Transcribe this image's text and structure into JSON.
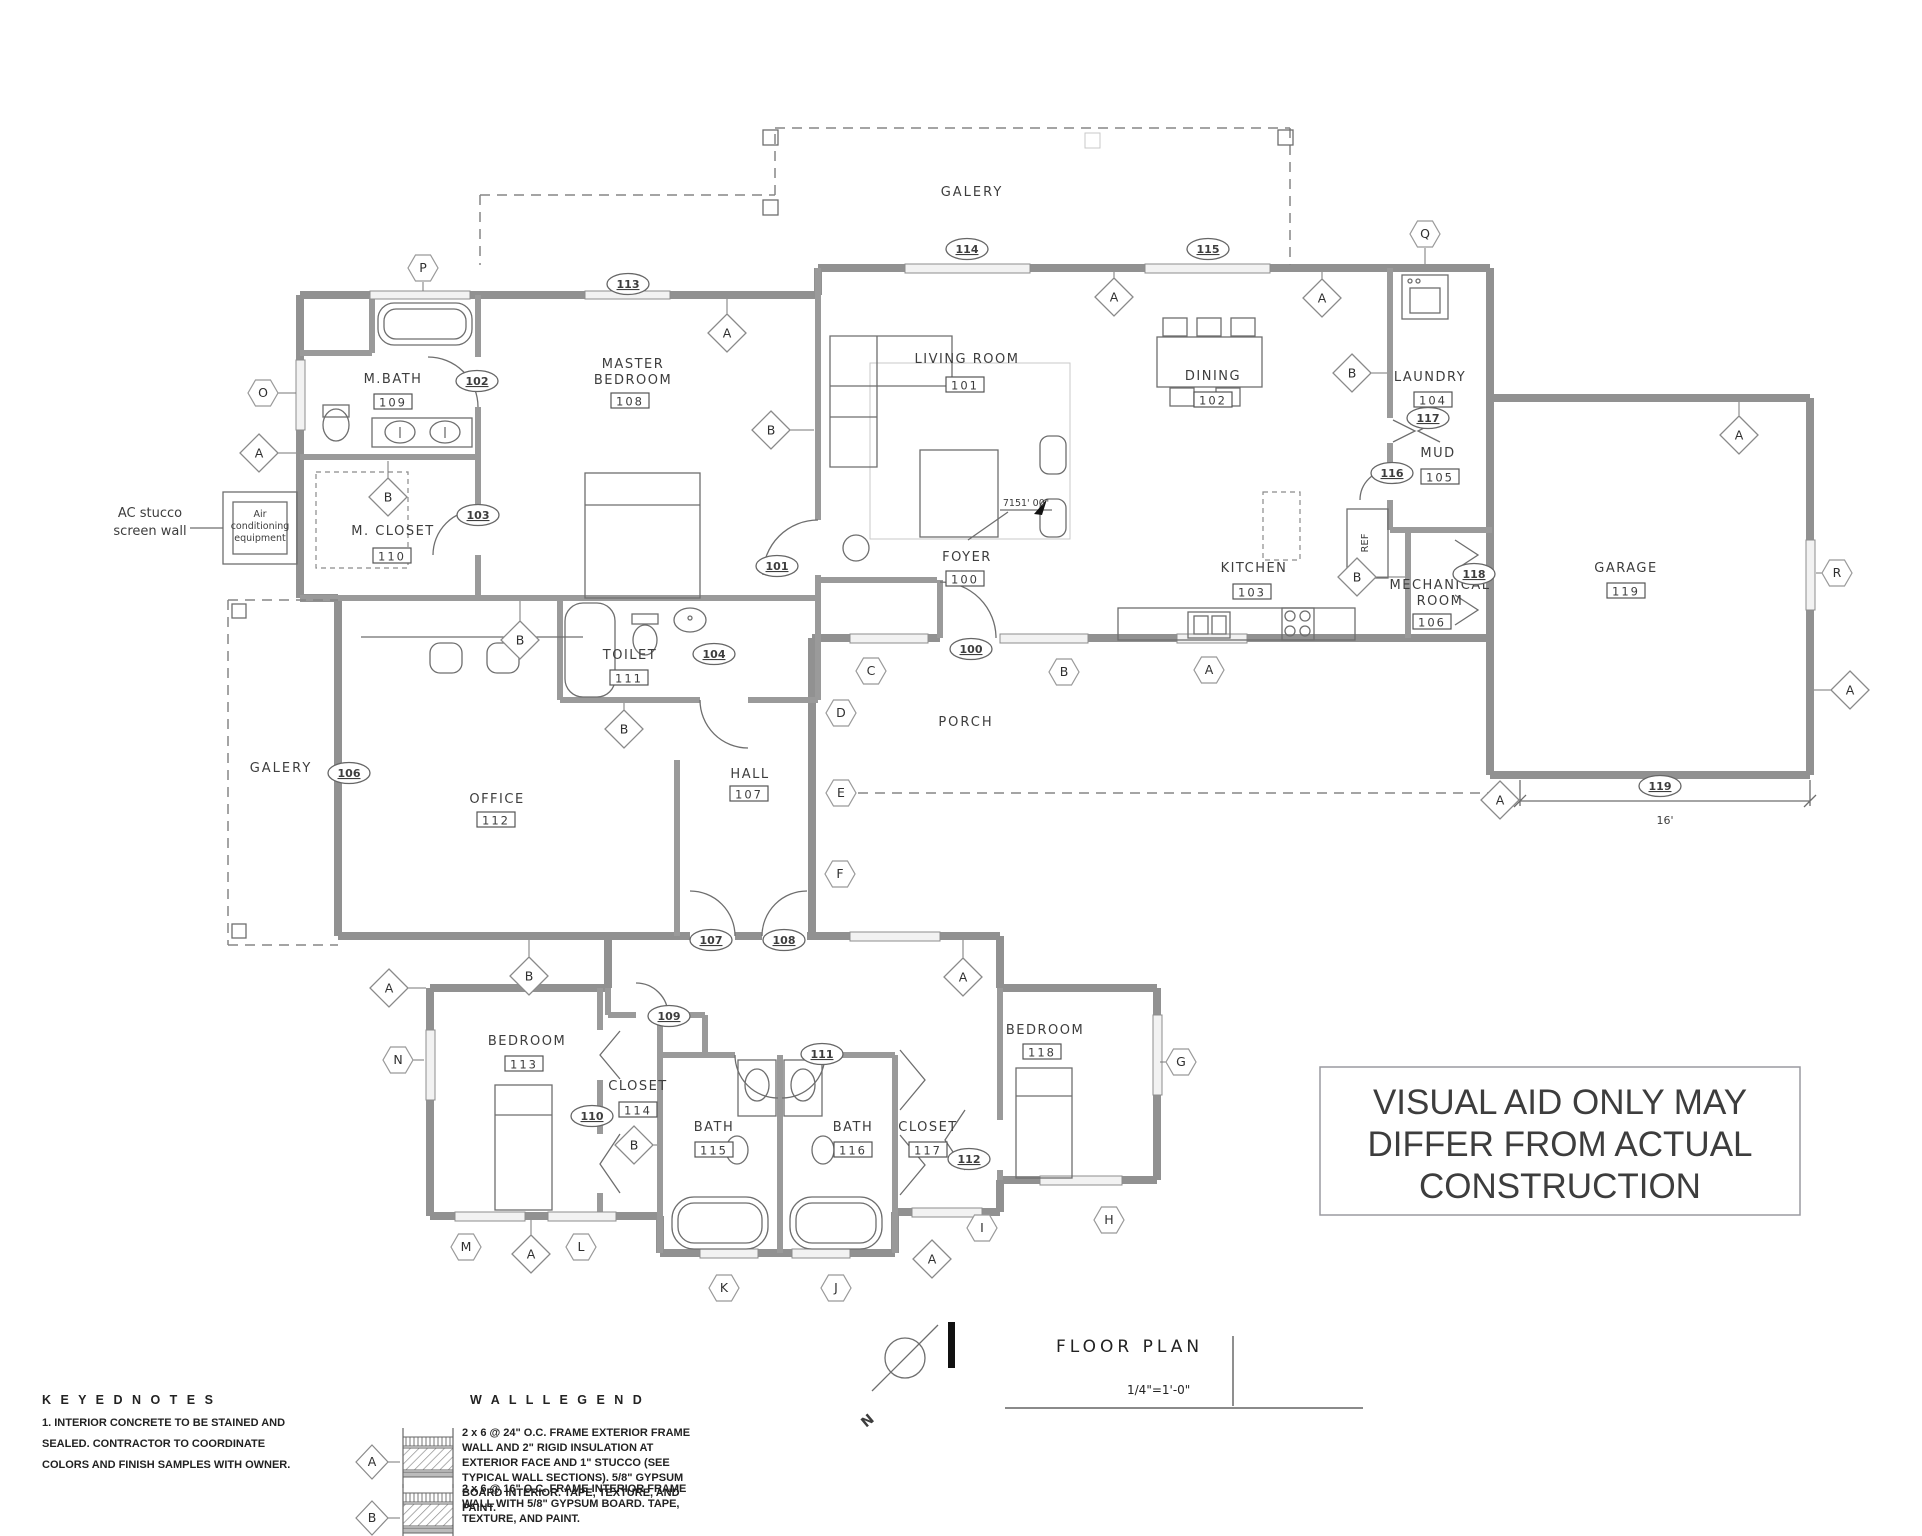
{
  "title_block": {
    "title": "FLOOR PLAN",
    "scale": "1/4\"=1'-0\""
  },
  "north_label": "N",
  "disclaimer": {
    "color": "#dc2f27",
    "lines": [
      "VISUAL AID ONLY MAY",
      "DIFFER FROM ACTUAL",
      "CONSTRUCTION"
    ]
  },
  "rooms": [
    {
      "name": [
        "LIVING ROOM"
      ],
      "num": "101",
      "x": 967,
      "y": 363,
      "bx": 965,
      "by": 385
    },
    {
      "name": [
        "DINING"
      ],
      "num": "102",
      "x": 1213,
      "y": 380,
      "bx": 1213,
      "by": 400
    },
    {
      "name": [
        "KITCHEN"
      ],
      "num": "103",
      "x": 1254,
      "y": 572,
      "bx": 1252,
      "by": 592
    },
    {
      "name": [
        "LAUNDRY"
      ],
      "num": "104",
      "x": 1430,
      "y": 381,
      "bx": 1433,
      "by": 400
    },
    {
      "name": [
        "MUD"
      ],
      "num": "105",
      "x": 1438,
      "y": 457,
      "bx": 1440,
      "by": 477
    },
    {
      "name": [
        "MECHANICAL",
        "ROOM"
      ],
      "num": "106",
      "x": 1440,
      "y": 589,
      "bx": 1432,
      "by": 622
    },
    {
      "name": [
        "HALL"
      ],
      "num": "107",
      "x": 750,
      "y": 778,
      "bx": 749,
      "by": 794
    },
    {
      "name": [
        "MASTER",
        "BEDROOM"
      ],
      "num": "108",
      "x": 633,
      "y": 368,
      "bx": 630,
      "by": 401
    },
    {
      "name": [
        "M.BATH"
      ],
      "num": "109",
      "x": 393,
      "y": 383,
      "bx": 393,
      "by": 402
    },
    {
      "name": [
        "M. CLOSET"
      ],
      "num": "110",
      "x": 393,
      "y": 535,
      "bx": 392,
      "by": 556
    },
    {
      "name": [
        "TOILET"
      ],
      "num": "111",
      "x": 630,
      "y": 659,
      "bx": 629,
      "by": 678
    },
    {
      "name": [
        "OFFICE"
      ],
      "num": "112",
      "x": 497,
      "y": 803,
      "bx": 496,
      "by": 820
    },
    {
      "name": [
        "BEDROOM"
      ],
      "num": "113",
      "x": 527,
      "y": 1045,
      "bx": 524,
      "by": 1064
    },
    {
      "name": [
        "CLOSET"
      ],
      "num": "114",
      "x": 638,
      "y": 1090,
      "bx": 638,
      "by": 1110
    },
    {
      "name": [
        "BATH"
      ],
      "num": "115",
      "x": 714,
      "y": 1131,
      "bx": 714,
      "by": 1150
    },
    {
      "name": [
        "BATH"
      ],
      "num": "116",
      "x": 853,
      "y": 1131,
      "bx": 853,
      "by": 1150
    },
    {
      "name": [
        "CLOSET"
      ],
      "num": "117",
      "x": 928,
      "y": 1131,
      "bx": 928,
      "by": 1150
    },
    {
      "name": [
        "BEDROOM"
      ],
      "num": "118",
      "x": 1045,
      "y": 1034,
      "bx": 1042,
      "by": 1052
    },
    {
      "name": [
        "GARAGE"
      ],
      "num": "119",
      "x": 1626,
      "y": 572,
      "bx": 1626,
      "by": 591
    },
    {
      "name": [
        "FOYER"
      ],
      "num": "100",
      "x": 967,
      "y": 561,
      "bx": 965,
      "by": 579
    }
  ],
  "plain_labels": [
    {
      "t": "GALERY",
      "x": 972,
      "y": 196,
      "s": 13,
      "ls": 2
    },
    {
      "t": "GALERY",
      "x": 281,
      "y": 772,
      "s": 13,
      "ls": 2
    },
    {
      "t": "PORCH",
      "x": 966,
      "y": 726,
      "s": 13,
      "ls": 2
    },
    {
      "t": "REF",
      "x": 1368,
      "y": 543,
      "s": 10,
      "rot": -90
    },
    {
      "t": "7151' 00\"",
      "x": 1026,
      "y": 506,
      "s": 9.5
    },
    {
      "t": "16'",
      "x": 1665,
      "y": 824,
      "s": 11
    },
    {
      "t": "AC stucco",
      "x": 150,
      "y": 517,
      "s": 13,
      "a": "middle"
    },
    {
      "t": "screen wall",
      "x": 150,
      "y": 535,
      "s": 13,
      "a": "middle"
    },
    {
      "t": "Air",
      "x": 260,
      "y": 517,
      "s": 9.5,
      "a": "middle"
    },
    {
      "t": "conditioning",
      "x": 260,
      "y": 529,
      "s": 9.5,
      "a": "middle"
    },
    {
      "t": "equipment",
      "x": 260,
      "y": 541,
      "s": 9.5,
      "a": "middle"
    }
  ],
  "door_tags": [
    {
      "n": "100",
      "x": 971,
      "y": 649
    },
    {
      "n": "101",
      "x": 777,
      "y": 566
    },
    {
      "n": "102",
      "x": 477,
      "y": 381
    },
    {
      "n": "103",
      "x": 478,
      "y": 515
    },
    {
      "n": "104",
      "x": 714,
      "y": 654
    },
    {
      "n": "106",
      "x": 349,
      "y": 773
    },
    {
      "n": "107",
      "x": 711,
      "y": 940
    },
    {
      "n": "108",
      "x": 784,
      "y": 940
    },
    {
      "n": "109",
      "x": 669,
      "y": 1016
    },
    {
      "n": "110",
      "x": 592,
      "y": 1116
    },
    {
      "n": "111",
      "x": 822,
      "y": 1054
    },
    {
      "n": "112",
      "x": 969,
      "y": 1159
    },
    {
      "n": "113",
      "x": 628,
      "y": 284
    },
    {
      "n": "114",
      "x": 967,
      "y": 249
    },
    {
      "n": "115",
      "x": 1208,
      "y": 249
    },
    {
      "n": "116",
      "x": 1392,
      "y": 473
    },
    {
      "n": "117",
      "x": 1428,
      "y": 418
    },
    {
      "n": "118",
      "x": 1474,
      "y": 574
    },
    {
      "n": "119",
      "x": 1660,
      "y": 786
    }
  ],
  "wall_type_markers": [
    {
      "l": "A",
      "x": 259,
      "y": 453,
      "lx": 296,
      "ly": 453
    },
    {
      "l": "A",
      "x": 727,
      "y": 333,
      "lx": 727,
      "ly": 299
    },
    {
      "l": "A",
      "x": 1114,
      "y": 297,
      "lx": 1114,
      "ly": 272
    },
    {
      "l": "A",
      "x": 1322,
      "y": 298,
      "lx": 1322,
      "ly": 272
    },
    {
      "l": "A",
      "x": 1739,
      "y": 435,
      "lx": 1739,
      "ly": 402
    },
    {
      "l": "A",
      "x": 389,
      "y": 988,
      "lx": 426,
      "ly": 988
    },
    {
      "l": "A",
      "x": 963,
      "y": 977,
      "lx": 963,
      "ly": 940
    },
    {
      "l": "A",
      "x": 531,
      "y": 1254,
      "lx": 531,
      "ly": 1220
    },
    {
      "l": "A",
      "x": 932,
      "y": 1259,
      "lx": 932,
      "ly": 1256
    },
    {
      "l": "A",
      "x": 1500,
      "y": 800
    },
    {
      "l": "A",
      "x": 1850,
      "y": 690,
      "lx": 1814,
      "ly": 690
    },
    {
      "l": "B",
      "x": 388,
      "y": 497,
      "lx": 388,
      "ly": 461
    },
    {
      "l": "B",
      "x": 771,
      "y": 430,
      "lx": 814,
      "ly": 430
    },
    {
      "l": "B",
      "x": 520,
      "y": 640,
      "lx": 520,
      "ly": 601
    },
    {
      "l": "B",
      "x": 624,
      "y": 729,
      "lx": 624,
      "ly": 703
    },
    {
      "l": "B",
      "x": 529,
      "y": 976,
      "lx": 529,
      "ly": 940
    },
    {
      "l": "B",
      "x": 634,
      "y": 1145,
      "lx": 657,
      "ly": 1145
    },
    {
      "l": "B",
      "x": 1352,
      "y": 373,
      "lx": 1387,
      "ly": 373
    },
    {
      "l": "B",
      "x": 1357,
      "y": 577,
      "lx": 1405,
      "ly": 577
    }
  ],
  "elevation_markers": [
    {
      "l": "C",
      "x": 871,
      "y": 671
    },
    {
      "l": "D",
      "x": 841,
      "y": 713
    },
    {
      "l": "E",
      "x": 841,
      "y": 793
    },
    {
      "l": "F",
      "x": 840,
      "y": 874
    },
    {
      "l": "B",
      "x": 1064,
      "y": 672
    },
    {
      "l": "A",
      "x": 1209,
      "y": 670
    },
    {
      "l": "G",
      "x": 1181,
      "y": 1062,
      "lx": 1160,
      "ly": 1062
    },
    {
      "l": "H",
      "x": 1109,
      "y": 1220
    },
    {
      "l": "I",
      "x": 982,
      "y": 1228
    },
    {
      "l": "J",
      "x": 836,
      "y": 1288
    },
    {
      "l": "K",
      "x": 724,
      "y": 1288
    },
    {
      "l": "L",
      "x": 581,
      "y": 1247
    },
    {
      "l": "M",
      "x": 466,
      "y": 1247
    },
    {
      "l": "N",
      "x": 398,
      "y": 1060,
      "lx": 424,
      "ly": 1060
    },
    {
      "l": "O",
      "x": 263,
      "y": 393,
      "lx": 296,
      "ly": 393
    },
    {
      "l": "P",
      "x": 423,
      "y": 268,
      "lx": 423,
      "ly": 291
    },
    {
      "l": "Q",
      "x": 1425,
      "y": 234,
      "lx": 1425,
      "ly": 264
    },
    {
      "l": "R",
      "x": 1837,
      "y": 573,
      "lx": 1816,
      "ly": 573
    }
  ],
  "keyed_notes": {
    "header": "K E Y E D N O T E S",
    "lines": [
      "1.      INTERIOR CONCRETE TO BE STAINED AND",
      "SEALED.       CONTRACTOR TO COORDINATE",
      "COLORS AND FINISH SAMPLES WITH OWNER."
    ]
  },
  "wall_legend": {
    "header": "W A L L L E G E N D",
    "items": [
      {
        "tag": "A",
        "lines": [
          "2 x 6 @ 24\" O.C. FRAME EXTERIOR FRAME",
          "WALL AND 2\" RIGID INSULATION AT",
          "EXTERIOR FACE AND 1\" STUCCO (SEE",
          "TYPICAL WALL SECTIONS). 5/8\" GYPSUM",
          "BOARD INTERIOR. TAPE, TEXTURE, AND",
          "PAINT."
        ]
      },
      {
        "tag": "B",
        "lines": [
          "2 x 6 @ 16\" O.C. FRAME INTERIOR FRAME",
          "WALL WITH 5/8\" GYPSUM BOARD. TAPE,",
          "TEXTURE, AND PAINT."
        ]
      }
    ]
  }
}
